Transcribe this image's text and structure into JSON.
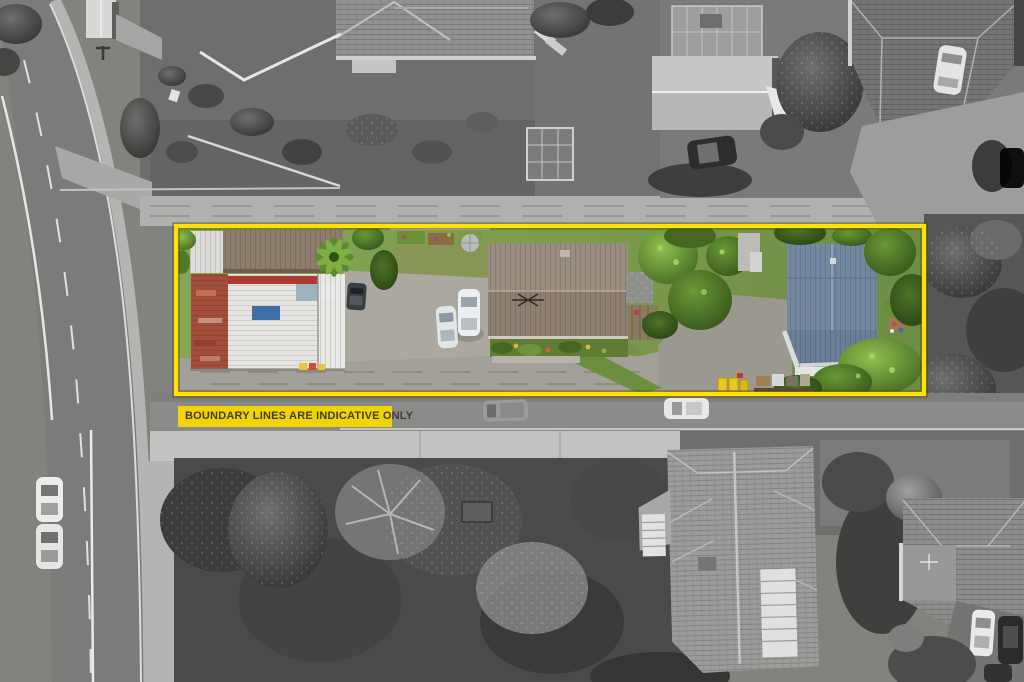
{
  "annotation": {
    "label": "BOUNDARY LINES ARE INDICATIVE ONLY"
  },
  "colors": {
    "boundary_yellow": "#FFE103",
    "boundary_edge": "#4A4A30",
    "label_bg": "#F2D406",
    "label_text": "#3E3E32"
  },
  "scene": {
    "kind": "aerial-drone-photo",
    "treatment": "subject property shown in colour inside yellow boundary; surroundings desaturated to grayscale",
    "property": {
      "outbuilding": "white and rust corrugated-iron garage shed",
      "main_house": "brown-roof single-storey house with TV aerial",
      "rear_house": "blue-grey roof house",
      "features": [
        "palm tree",
        "gravel driveway",
        "parked cars",
        "yellow wheelie bins",
        "garden beds",
        "mature trees"
      ]
    },
    "surroundings": [
      "curved road with lane markings on left",
      "street with parked cars below the lot",
      "neighbouring houses, shed and greenhouse above",
      "large hip-roof villa bottom right",
      "dense dark trees bottom centre"
    ]
  }
}
